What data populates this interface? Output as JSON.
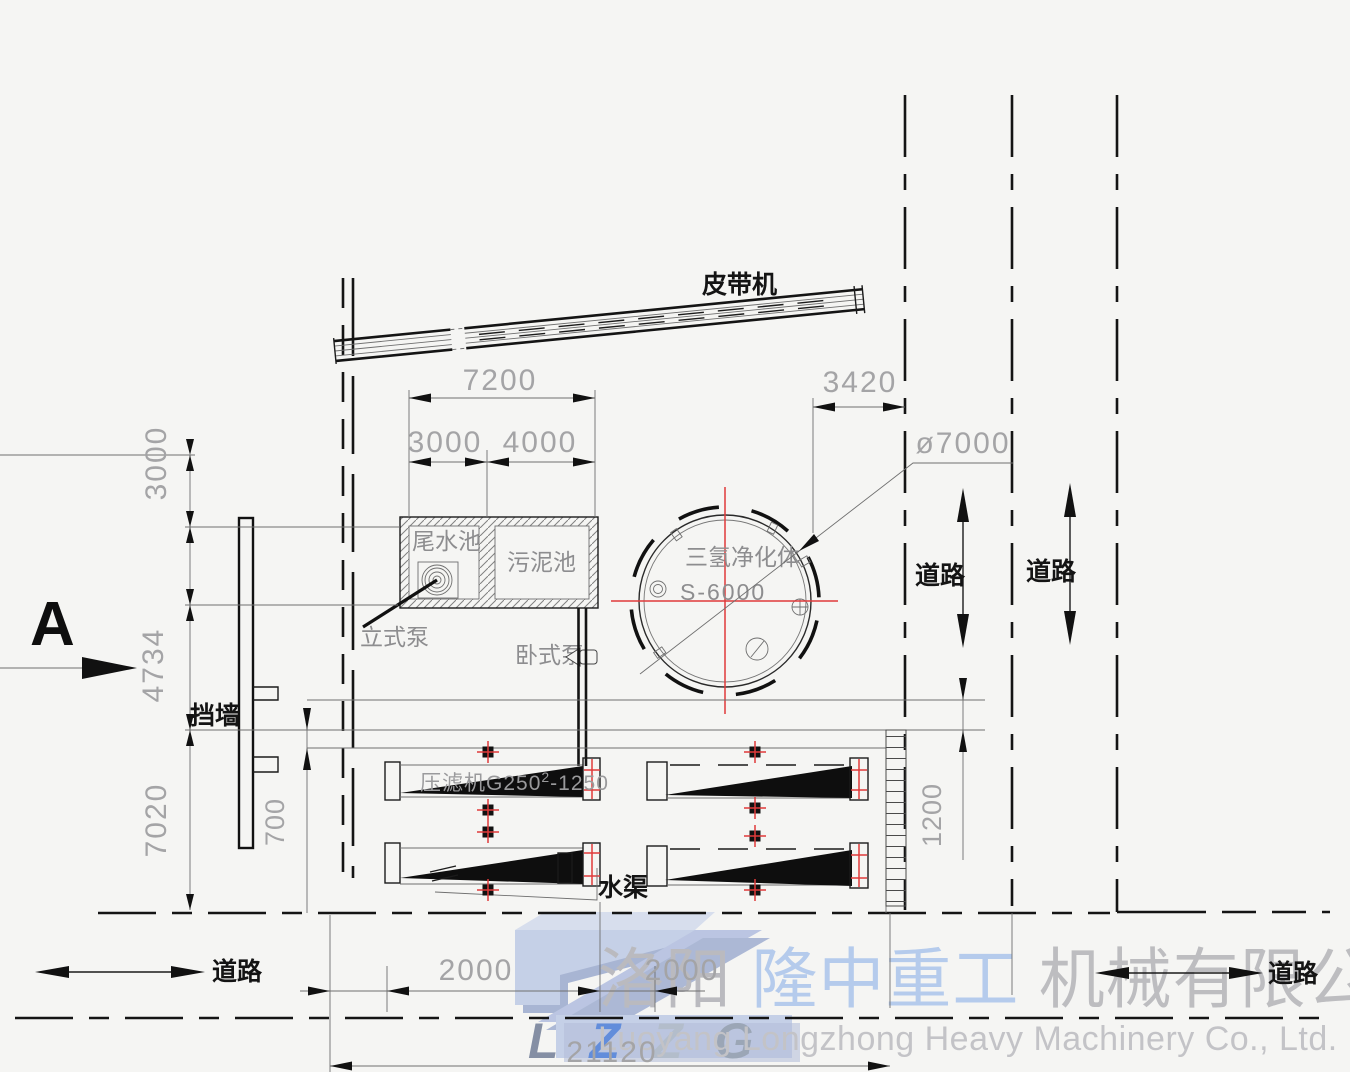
{
  "drawing": {
    "labels": {
      "belt_conveyor": "皮带机",
      "tailwater_pool": "尾水池",
      "sludge_pool": "污泥池",
      "vertical_pump": "立式泵",
      "horizontal_pump": "卧式泵",
      "purifier_name": "三氢净化体",
      "purifier_model": "S-6000",
      "filter_press_prefix": "压滤机G250",
      "filter_press_sup": "2",
      "filter_press_suffix": "-1250",
      "retaining_wall": "挡墙",
      "water_channel": "水渠",
      "section_marker": "A",
      "road": "道路"
    },
    "dimensions": {
      "pool_total_width": "7200",
      "pool_left_width": "3000",
      "pool_right_width": "4000",
      "tank_to_road": "3420",
      "tank_diameter": "ø7000",
      "left_top": "3000",
      "left_mid": "4734",
      "left_bottom": "7020",
      "wall_offset": "700",
      "right_gap": "1200",
      "bottom_gap_1": "2000",
      "bottom_gap_2": "2000",
      "bottom_total": "21120"
    },
    "colors": {
      "centerline_red": "#e03a3a",
      "line_black": "#1b1b1b",
      "dim_gray": "#a4a4a6",
      "watermark_blue": "#a9bee6",
      "watermark_gray": "#b9b9bd"
    }
  },
  "watermark": {
    "logo_text": "LZZG",
    "logo_letters": [
      "L",
      "Z",
      "Z",
      "G"
    ],
    "company_cn_1": "洛阳",
    "company_cn_2": "隆中重工",
    "company_cn_3": "机械有限公司",
    "company_en": "Luoyang Longzhong Heavy Machinery Co., Ltd."
  }
}
